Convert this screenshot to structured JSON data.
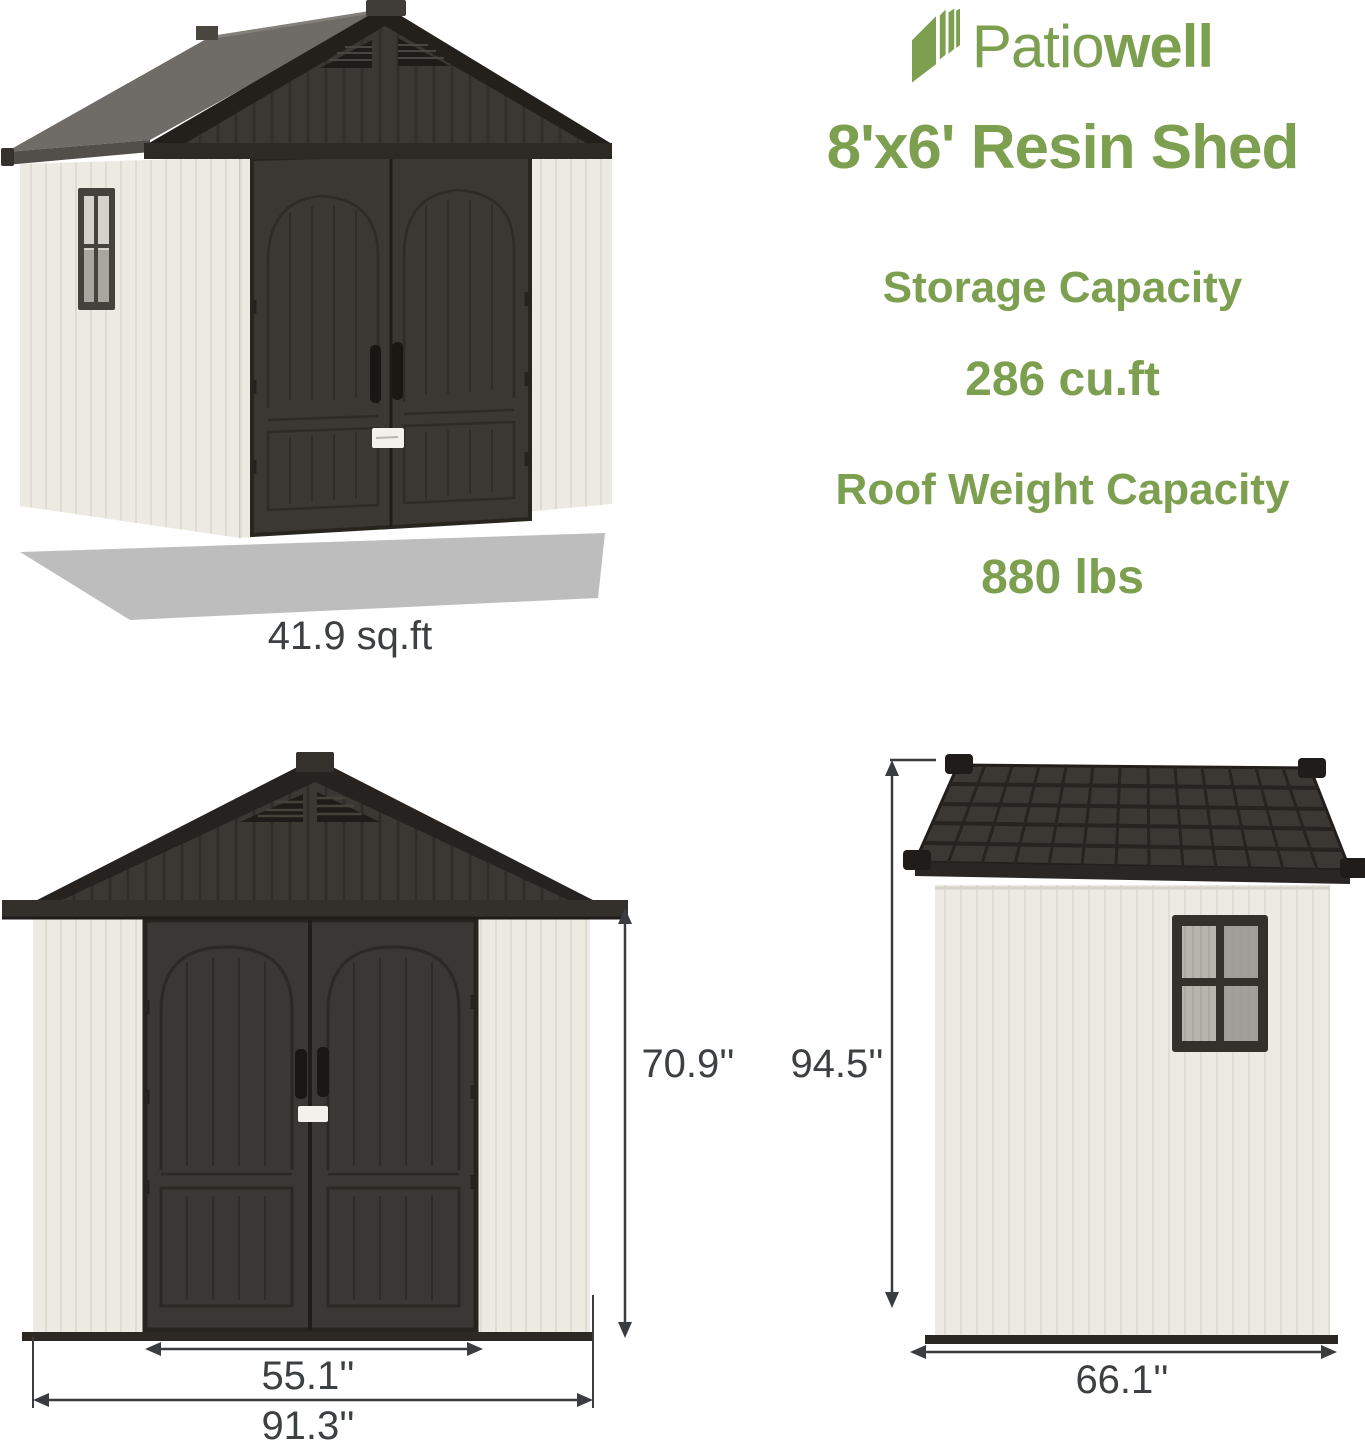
{
  "brand": {
    "word_regular": "Patio",
    "word_bold": "well",
    "logo_icon": "layered-panels-icon"
  },
  "product": {
    "title": "8'x6' Resin Shed"
  },
  "specs": {
    "storage": {
      "label": "Storage Capacity",
      "value": "286 cu.ft"
    },
    "roof": {
      "label": "Roof Weight Capacity",
      "value": "880 lbs"
    }
  },
  "views": {
    "perspective": {
      "floor_area": "41.9 sq.ft"
    },
    "front": {
      "wall_height": "70.9''",
      "door_width": "55.1''",
      "overall_width": "91.3''"
    },
    "side": {
      "peak_height": "94.5''",
      "overall_depth": "66.1''"
    }
  },
  "colors": {
    "brand_green": "#7d9f50",
    "roof_dark": "#3a3733",
    "door_dark": "#3b3734",
    "wall_white": "#edeae3",
    "shadow_gray": "#bdbdbd",
    "dimension_text": "#3d4043"
  }
}
